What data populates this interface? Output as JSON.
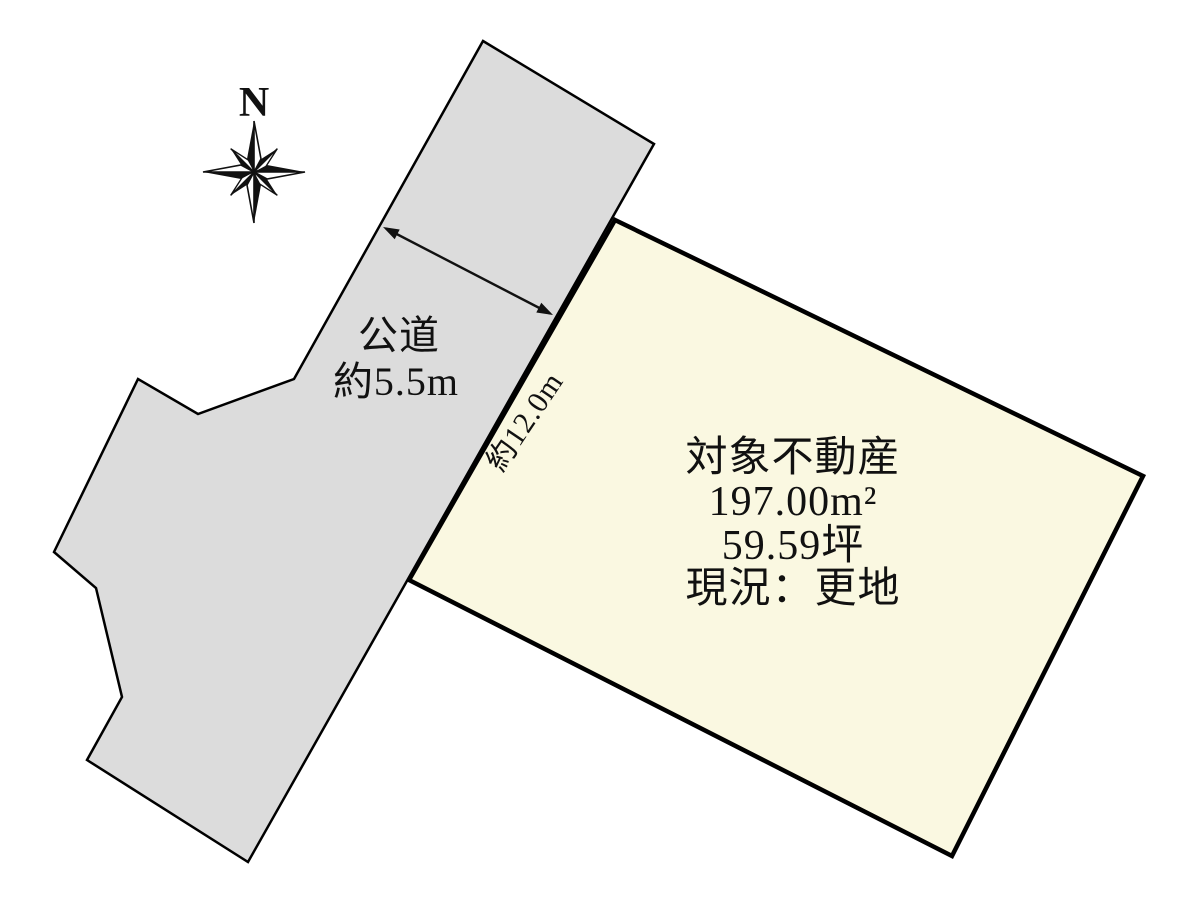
{
  "compass": {
    "north": "N"
  },
  "road": {
    "name": "公道",
    "width": "約5.5m"
  },
  "parcel": {
    "title": "対象不動産",
    "area_sqm": "197.00m²",
    "area_tsubo": "59.59坪",
    "status": "現況：更地",
    "frontage": "約12.0m"
  },
  "colors": {
    "background": "#ffffff",
    "road_fill": "#dcdcdc",
    "road_stroke": "#000000",
    "parcel_fill": "#faf8e1",
    "parcel_stroke": "#000000",
    "text": "#111111"
  }
}
